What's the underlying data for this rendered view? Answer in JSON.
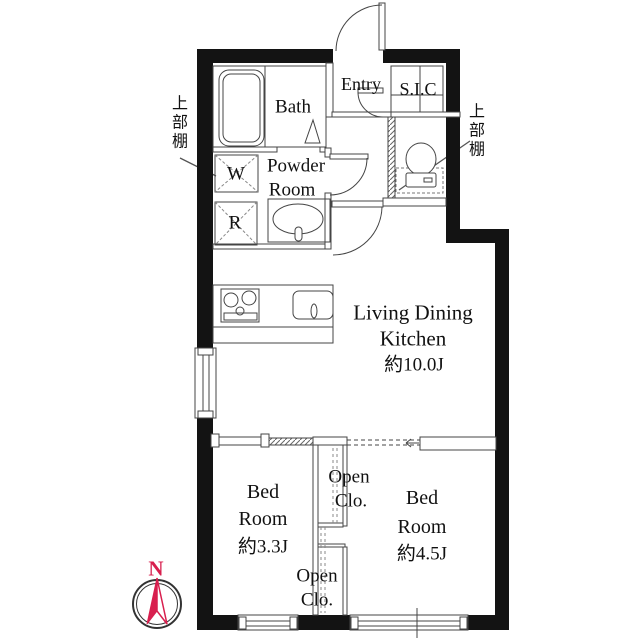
{
  "labels": {
    "bath": "Bath",
    "powder_line1": "Powder",
    "powder_line2": "Room",
    "entry": "Entry",
    "sic": "S.I.C",
    "washer": "W",
    "fridge": "R",
    "ldk_line1": "Living Dining",
    "ldk_line2": "Kitchen",
    "ldk_size": "約10.0J",
    "bed_small_line1": "Bed",
    "bed_small_line2": "Room",
    "bed_small_size": "約3.3J",
    "bed_large_line1": "Bed",
    "bed_large_line2": "Room",
    "bed_large_size": "約4.5J",
    "open_closet_upper_line1": "Open",
    "open_closet_upper_line2": "Clo.",
    "open_closet_lower_line1": "Open",
    "open_closet_lower_line2": "Clo.",
    "shelf_left": "上部棚",
    "shelf_right": "上部棚",
    "compass_north": "N"
  },
  "colors": {
    "wall": "#131313",
    "line": "#444444",
    "accent_red": "#d81f4e",
    "background": "#ffffff"
  }
}
